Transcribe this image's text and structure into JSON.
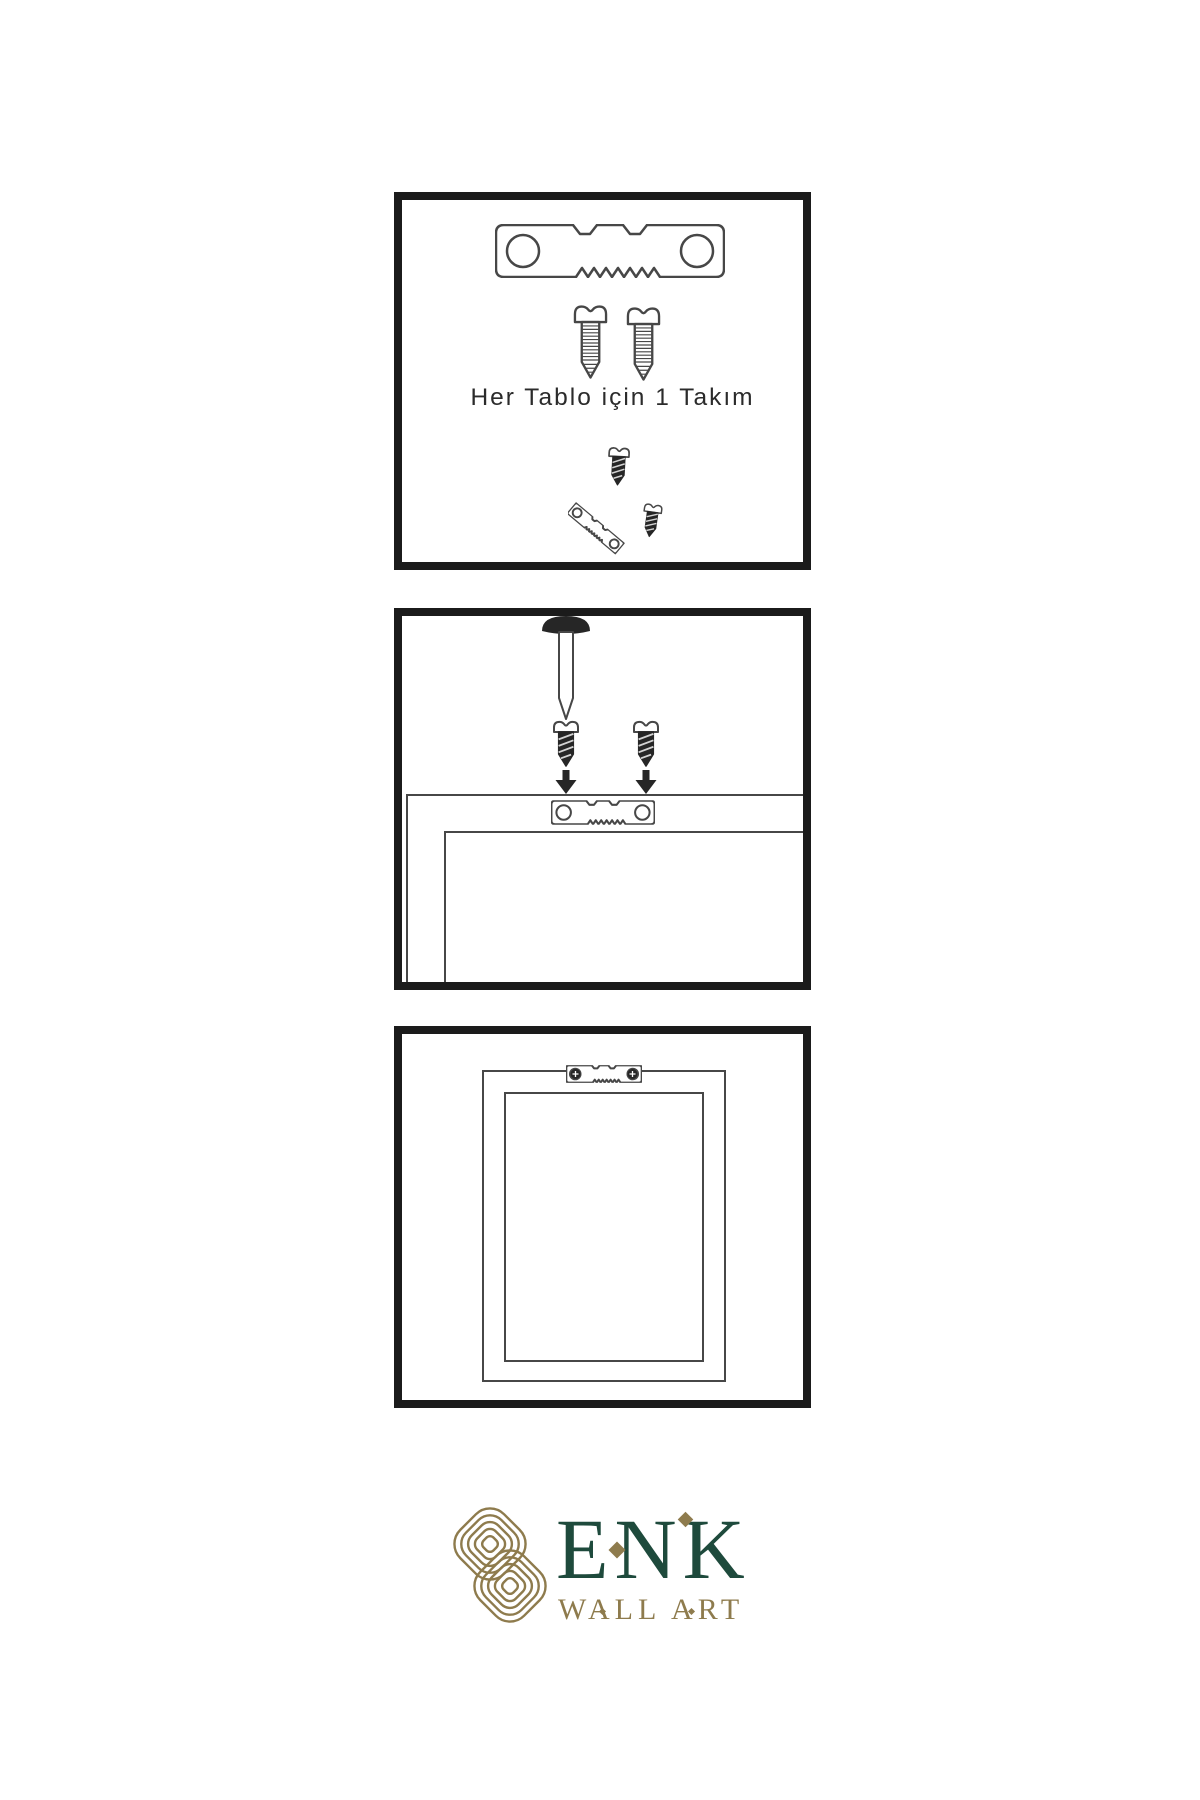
{
  "colors": {
    "background": "#ffffff",
    "panel_border": "#1b1b1b",
    "line": "#474747",
    "dark": "#262626",
    "logo_green": "#1e4a3c",
    "logo_gold": "#8e7b4d",
    "caption": "#2b2b2b"
  },
  "panel1": {
    "caption": "Her Tablo için 1 Takım",
    "icons": [
      "sawtooth-hanger-icon",
      "screw-icon",
      "screw-icon",
      "screw-into-hanger-icon"
    ]
  },
  "panel2": {
    "icons": [
      "wall-nail-icon",
      "screw-icon",
      "screw-icon",
      "down-arrow-icon",
      "down-arrow-icon",
      "picture-frame-back-icon",
      "sawtooth-hanger-icon"
    ]
  },
  "panel3": {
    "icons": [
      "picture-frame-back-icon",
      "mounted-sawtooth-hanger-icon",
      "screw-head-icon",
      "screw-head-icon"
    ]
  },
  "logo": {
    "brand": "ENK",
    "subtitle": "WALL ART",
    "icons": [
      "celtic-knot-icon",
      "diamond-icon"
    ]
  }
}
